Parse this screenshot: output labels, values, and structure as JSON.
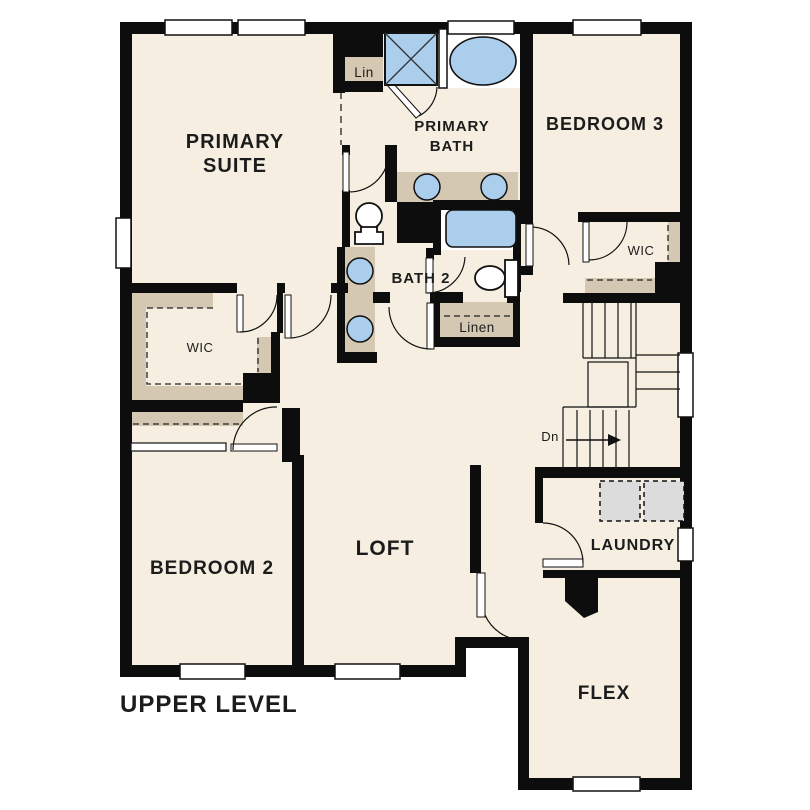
{
  "title": {
    "label": "UPPER LEVEL"
  },
  "colors": {
    "floor": "#f6efe1",
    "wall": "#0d0d0d",
    "cabinet": "#d4c8b2",
    "fixture": "#abceec",
    "appliance": "#dcdcdc",
    "text": "#1c1c1c"
  },
  "rooms": {
    "primary_suite": {
      "line1": "PRIMARY",
      "line2": "SUITE"
    },
    "primary_bath": {
      "line1": "PRIMARY",
      "line2": "BATH"
    },
    "bedroom_3": {
      "label": "BEDROOM 3"
    },
    "wic_bedroom_3": {
      "label": "WIC"
    },
    "bath_2": {
      "label": "BATH 2"
    },
    "linen": {
      "label": "Linen"
    },
    "lin": {
      "label": "Lin"
    },
    "wic_primary": {
      "label": "WIC"
    },
    "bedroom_2": {
      "label": "BEDROOM 2"
    },
    "loft": {
      "label": "LOFT"
    },
    "laundry": {
      "label": "LAUNDRY"
    },
    "flex": {
      "label": "FLEX"
    },
    "stairs": {
      "down_label": "Dn"
    }
  }
}
